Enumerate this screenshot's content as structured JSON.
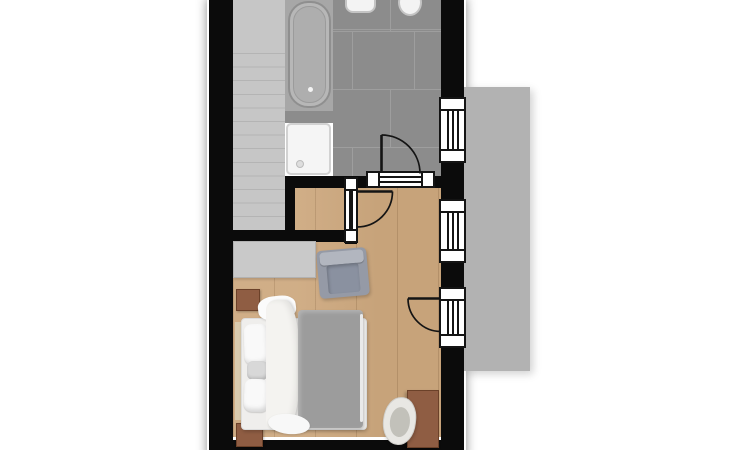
{
  "page": {
    "kind": "architectural floor plan, top-down render, no text labels",
    "background": "#ffffff"
  },
  "floor_plan": {
    "rooms": [
      {
        "id": "bathroom",
        "floor": "gray ceramic tile",
        "fixtures": [
          "bathtub",
          "shower-tray",
          "washbasin",
          "toilet"
        ]
      },
      {
        "id": "staircase",
        "floor": "gray steps",
        "visible_steps": 13
      },
      {
        "id": "landing",
        "floor": "wood"
      },
      {
        "id": "bedroom",
        "floor": "light oak wood planks",
        "furniture": [
          "double-bed",
          "dresser",
          "armchair",
          "nightstand-top",
          "nightstand-bottom",
          "desk",
          "desk-chair"
        ]
      },
      {
        "id": "terrace",
        "floor": "gray concrete slab"
      }
    ],
    "openings": {
      "windows": [
        {
          "id": "bathroom-window",
          "wall": "right"
        },
        {
          "id": "bedroom-window",
          "wall": "right"
        }
      ],
      "doors": [
        {
          "id": "bathroom-door",
          "between": [
            "bedroom",
            "bathroom"
          ],
          "swing": "into-bathroom"
        },
        {
          "id": "bedroom-door",
          "between": [
            "landing",
            "bedroom"
          ],
          "swing": "into-bedroom"
        },
        {
          "id": "terrace-door",
          "wall": "right",
          "swing": "into-bedroom"
        }
      ]
    },
    "colors": {
      "wall": "#0b0b0b",
      "tile": "#8c8c8c",
      "tile-joint": "#9e9e9e",
      "stairs": "#c6c6c6",
      "stair-line": "#b4b4b4",
      "platform": "#a7a7a7",
      "terrace": "#b2b2b2",
      "wood": "#cda87e",
      "wood-joint": "rgba(94,62,28,0.18)",
      "dresser": "#c9c9c9",
      "duvet": "#9c9c9c",
      "linen": "#f4f3f0",
      "headboard": "#d9caae",
      "brown": "#8f5d43",
      "brown-dark": "#6b4129",
      "chair-body": "#959aa6",
      "chair-cushion": "#b2b6bf",
      "chair-seat": "#8a91a0",
      "deskchair": "#e8e7e3",
      "deskchair-seat": "#c2c1ba",
      "fixture": "#f3f3f3",
      "fixture-border": "#c4c4c4",
      "shower": "#f5f5f5",
      "symbol-line": "#141414"
    }
  }
}
